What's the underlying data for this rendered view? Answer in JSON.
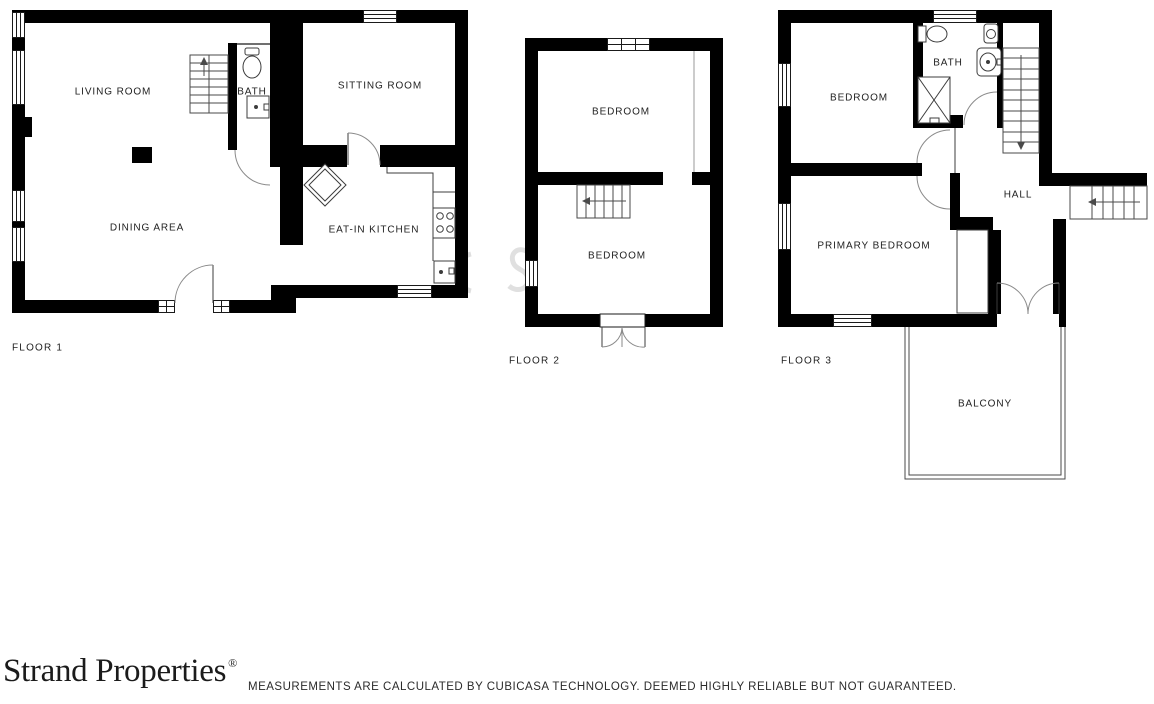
{
  "plan": {
    "floor1": {
      "label": "FLOOR 1",
      "living_room": "LIVING ROOM",
      "bath": "BATH",
      "sitting_room": "SITTING ROOM",
      "dining_area": "DINING AREA",
      "kitchen": "EAT-IN KITCHEN"
    },
    "floor2": {
      "label": "FLOOR 2",
      "bedroom_top": "BEDROOM",
      "bedroom_bottom": "BEDROOM"
    },
    "floor3": {
      "label": "FLOOR 3",
      "bedroom": "BEDROOM",
      "bath": "BATH",
      "hall": "HALL",
      "primary_bedroom": "PRIMARY BEDROOM",
      "balcony": "BALCONY"
    }
  },
  "footer": {
    "brand": "Strand Properties",
    "registered_mark": "®",
    "disclaimer": "MEASUREMENTS ARE CALCULATED BY CUBICASA TECHNOLOGY. DEEMED HIGHLY RELIABLE BUT NOT GUARANTEED."
  },
  "colors": {
    "wall": "#000000",
    "thin_line": "#3c3c3c",
    "door_arc": "#8a8a8a",
    "label_text": "#1f1f1f",
    "background": "#ffffff"
  }
}
